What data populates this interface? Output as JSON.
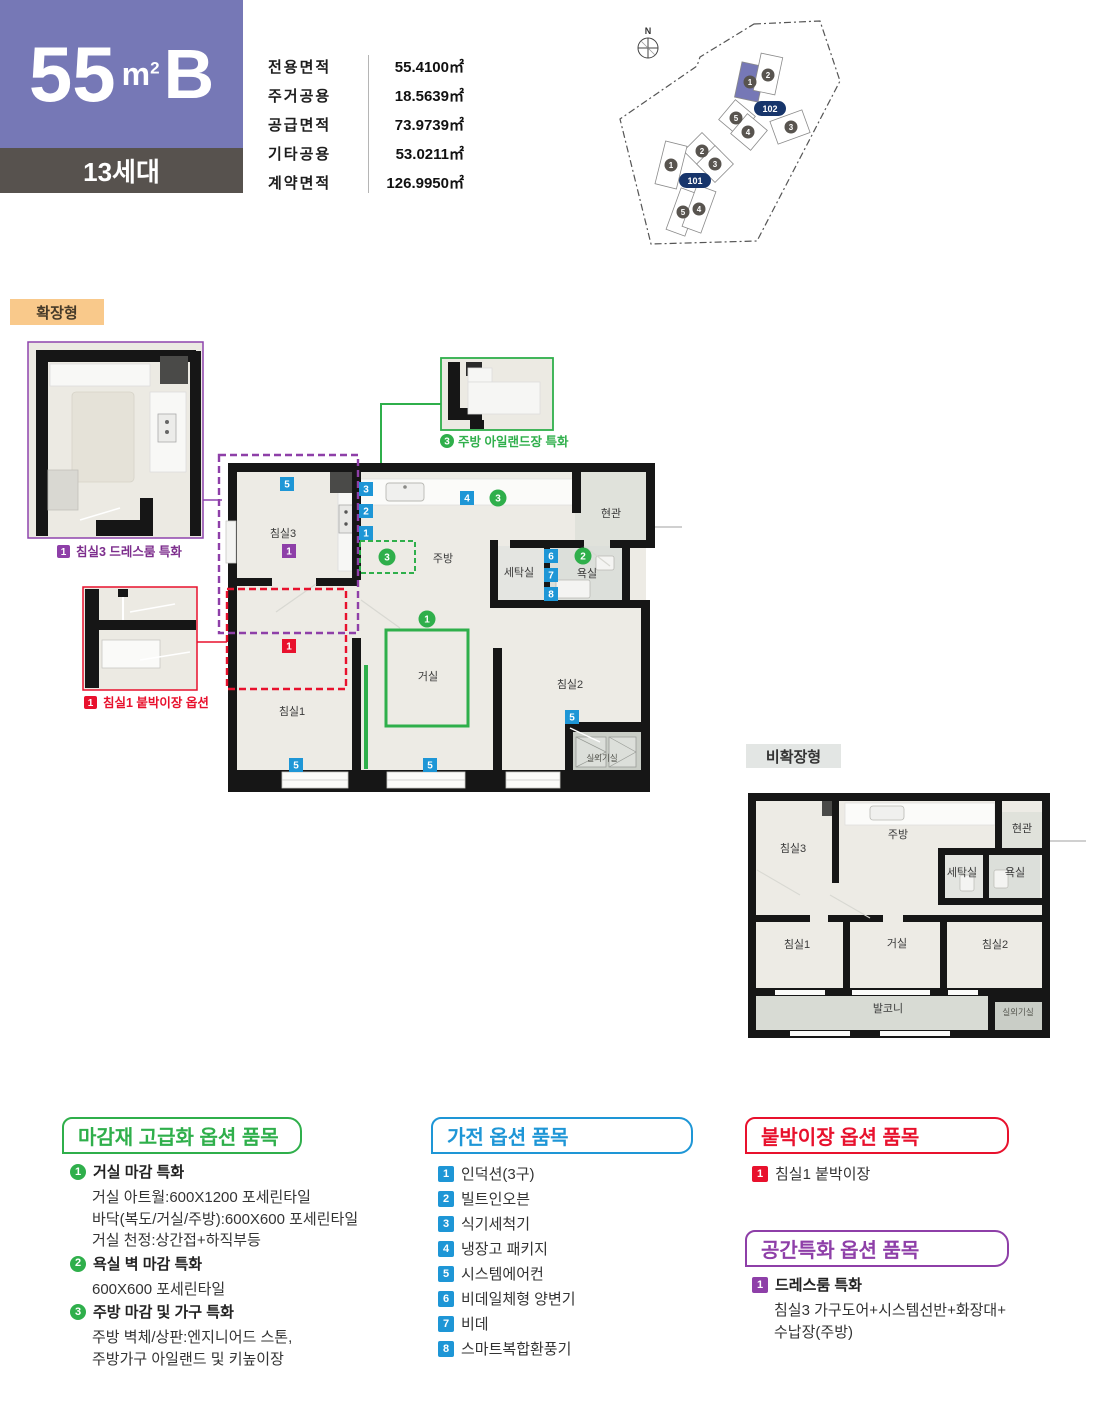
{
  "header": {
    "size": "55",
    "unit_m": "m",
    "unit_exp": "2",
    "type": "B",
    "households": "13세대",
    "area_table": [
      {
        "label": "전용면적",
        "value": "55.4100㎡"
      },
      {
        "label": "주거공용",
        "value": "18.5639㎡"
      },
      {
        "label": "공급면적",
        "value": "73.9739㎡"
      },
      {
        "label": "기타공용",
        "value": "53.0211㎡"
      },
      {
        "label": "계약면적",
        "value": "126.9950㎡"
      }
    ]
  },
  "site_plan": {
    "north_label": "N",
    "block_102": {
      "label": "102",
      "buildings": [
        "1",
        "2",
        "5",
        "4",
        "3"
      ]
    },
    "block_101": {
      "label": "101",
      "buildings": [
        "1",
        "2",
        "3",
        "5",
        "4"
      ]
    }
  },
  "nums": {
    "n1": "1",
    "n2": "2",
    "n3": "3",
    "n4": "4",
    "n5": "5",
    "n6": "6",
    "n7": "7",
    "n8": "8"
  },
  "plans": {
    "expanded": {
      "badge": "확장형",
      "rooms": {
        "bed3": "침실3",
        "kitchen": "주방",
        "entry": "현관",
        "laundry": "세탁실",
        "bath": "욕실",
        "bed1": "침실1",
        "living": "거실",
        "bed2": "침실2",
        "ac": "실외기실"
      },
      "insets": {
        "dress": {
          "num": "1",
          "caption": "침실3 드레스룸 특화"
        },
        "closet": {
          "num": "1",
          "caption": "침실1 붙박이장 옵션"
        },
        "island": {
          "num": "3",
          "caption": "주방 아일랜드장 특화"
        }
      }
    },
    "non_expanded": {
      "badge": "비확장형",
      "rooms": {
        "bed3": "침실3",
        "kitchen": "주방",
        "entry": "현관",
        "laundry": "세탁실",
        "bath": "욕실",
        "bed1": "침실1",
        "living": "거실",
        "bed2": "침실2",
        "balcony": "발코니",
        "ac": "실외기실"
      }
    }
  },
  "options": {
    "finish": {
      "title": "마감재 고급화 옵션 품목",
      "items": [
        {
          "num": "1",
          "title": "거실 마감 특화",
          "lines": [
            "거실 아트월:600X1200 포세린타일",
            "바닥(복도/거실/주방):600X600 포세린타일",
            "거실 천정:상간접+하직부등"
          ]
        },
        {
          "num": "2",
          "title": "욕실 벽 마감 특화",
          "lines": [
            "600X600 포세린타일"
          ]
        },
        {
          "num": "3",
          "title": "주방 마감 및 가구 특화",
          "lines": [
            "주방 벽체/상판:엔지니어드 스톤,",
            "주방가구 아일랜드 및 키높이장"
          ]
        }
      ]
    },
    "appliance": {
      "title": "가전 옵션 품목",
      "items": [
        "인덕션(3구)",
        "빌트인오븐",
        "식기세척기",
        "냉장고 패키지",
        "시스템에어컨",
        "비데일체형 양변기",
        "비데",
        "스마트복합환풍기"
      ]
    },
    "builtin": {
      "title": "붙박이장 옵션 품목",
      "items": [
        {
          "num": "1",
          "label": "침실1 붙박이장"
        }
      ]
    },
    "space": {
      "title": "공간특화 옵션 품목",
      "items": [
        {
          "num": "1",
          "title": "드레스룸 특화",
          "lines": [
            "침실3 가구도어+시스템선반+화장대+",
            "수납장(주방)"
          ]
        }
      ]
    }
  },
  "colors": {
    "brand_purple": "#7678b6",
    "badge_blue": "#1e96d6",
    "green": "#2faf4b",
    "red": "#e8112d",
    "purple": "#8e3fa8",
    "navy": "#17356b",
    "orange": "#f9c98b",
    "wall": "#161616"
  }
}
